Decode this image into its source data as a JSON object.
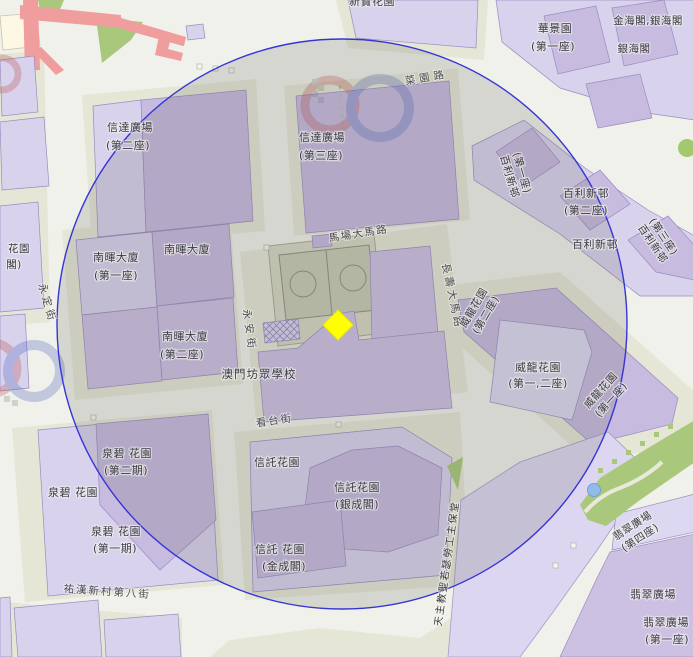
{
  "map": {
    "marker": {
      "kind": "selected-location",
      "shape": "diamond",
      "color": "#ffff00"
    },
    "radius_circle": {
      "stroke_color": "#3535d6",
      "fill_tint": "rgba(85,83,78,0.17)"
    },
    "colors": {
      "building_fill": "#cdc1e3",
      "building_fill_light": "#d8d2ed",
      "building_stroke": "#9a8cc0",
      "block_fill": "#e5e6d5",
      "road_background": "#f1f1eb",
      "green_area": "#aac87c",
      "elevated_road_pink": "#f09d9d",
      "pond_blue": "#93bbe7"
    }
  },
  "streets": {
    "choi_un": "菜園路",
    "ma_cheong": "馬場大馬路",
    "weng_on": "永安街",
    "weng_teng": "永定街",
    "cheong_sau": "長壽大馬路",
    "hon_toi": "看台街",
    "iao_hon_8": "祐漢新村第八街"
  },
  "places": {
    "san_pou": "新寶花園",
    "sun_tat_2a": "信達廣場",
    "sun_tat_2b": "(第二座)",
    "sun_tat_3a": "信達廣場",
    "sun_tat_3b": "(第三座)",
    "wa_keng_a": "華景園",
    "wa_keng_b": "(第一座)",
    "kam_hoi": "金海閣,銀海閣",
    "ngan_hoi": "銀海閣",
    "pak_lei_1a": "百利新邨",
    "pak_lei_1b": "(第一座)",
    "pak_lei_2a": "百利新邨",
    "pak_lei_2b": "(第二座)",
    "pak_lei": "百利新邨",
    "pak_lei_3a": "百利新邨",
    "pak_lei_3b": "(第三座)",
    "nam_fai_1a": "南暉大廈",
    "nam_fai_1b": "(第一座)",
    "nam_fai": "南暉大廈",
    "nam_fai_2a": "南暉大廈",
    "nam_fai_2b": "(第二座)",
    "school": "澳門坊眾學校",
    "wai_long_12a": "威龍花園",
    "wai_long_12b": "(第一,二座)",
    "wai_long_2a": "威龍花園",
    "wai_long_2b": "(第二座)",
    "wai_long_1a": "威龍花園",
    "wai_long_1b": "(第一座)",
    "chun_pek_2a": "泉碧 花園",
    "chun_pek_2b": "(第二期)",
    "chun_pek": "泉碧 花園",
    "chun_pek_1a": "泉碧 花園",
    "chun_pek_1b": "(第一期)",
    "son_tok": "信託花園",
    "son_tok_ngan_a": "信託花園",
    "son_tok_ngan_b": "(銀成閣)",
    "son_tok_kam_a": "信託 花園",
    "son_tok_kam_b": "(金成閣)",
    "church": "天主教聖若瑟勞工主保堂",
    "fei_choi_4a": "翡翠廣場",
    "fei_choi_4b": "(第四座)",
    "fei_choi_cut": "翡翠廣場",
    "fei_choi_1a": "翡翠廣場",
    "fei_choi_1b": "(第一座)",
    "edge_partial_a": "花園",
    "edge_partial_b": "閣)"
  }
}
